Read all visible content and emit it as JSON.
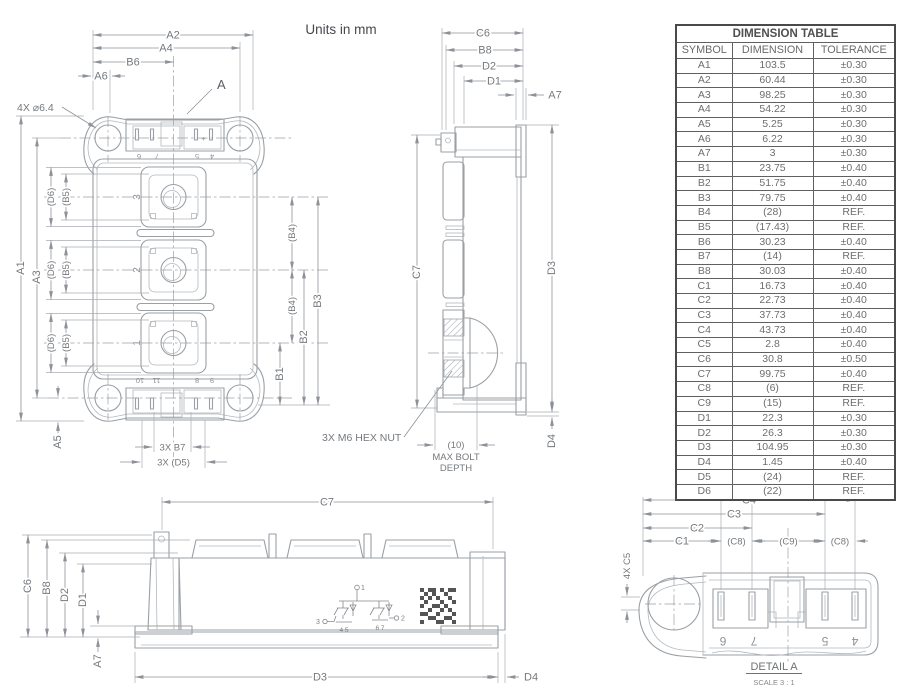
{
  "units_note": "Units in mm",
  "front_view": {
    "dims": {
      "a1": "A1",
      "a2": "A2",
      "a3": "A3",
      "a4": "A4",
      "a5": "A5",
      "a6": "A6",
      "b1": "B1",
      "b2": "B2",
      "b3": "B3",
      "b4": "(B4)",
      "b5": "(B5)",
      "b6": "B6",
      "d6": "(D6)",
      "b7": "3X B7",
      "d5": "3X (D5)"
    },
    "callouts": {
      "mounting_holes": "4X ⌀6.4",
      "detail": "A"
    },
    "terminal_numbers": [
      "3",
      "2",
      "1"
    ],
    "top_pin_numbers": [
      "6",
      "7",
      "5",
      "4"
    ],
    "bottom_pin_numbers": [
      "10",
      "11",
      "8",
      "9"
    ],
    "polarity_mark": "+"
  },
  "side_view": {
    "dims": {
      "c6": "C6",
      "b8": "B8",
      "d2": "D2",
      "d1": "D1",
      "a7": "A7",
      "c7": "C7",
      "d3": "D3",
      "d4": "D4"
    },
    "hex_nut_note": "3X M6 HEX NUT",
    "bolt_depth_note": [
      "(10)",
      "MAX BOLT",
      "DEPTH"
    ]
  },
  "bottom_view": {
    "dims": {
      "c7": "C7",
      "c6": "C6",
      "b8": "B8",
      "d2": "D2",
      "d1": "D1",
      "a7": "A7",
      "d3": "D3",
      "d4": "D4"
    },
    "schematic": {
      "node1": "1",
      "node2": "2",
      "node3": "3",
      "left_pins": "4 5",
      "right_pins": "6 7"
    }
  },
  "detail_view": {
    "dims": {
      "c1": "C1",
      "c2": "C2",
      "c3": "C3",
      "c4": "C4",
      "c8": "(C8)",
      "c9": "(C9)",
      "c5": "4X C5"
    },
    "pin_numbers": [
      "6",
      "7",
      "5",
      "4"
    ],
    "title": "DETAIL A",
    "scale_note": "SCALE 3 : 1"
  },
  "dimension_table": {
    "title": "DIMENSION TABLE",
    "columns": [
      "SYMBOL",
      "DIMENSION",
      "TOLERANCE"
    ],
    "rows": [
      [
        "A1",
        "103.5",
        "±0.30"
      ],
      [
        "A2",
        "60.44",
        "±0.30"
      ],
      [
        "A3",
        "98.25",
        "±0.30"
      ],
      [
        "A4",
        "54.22",
        "±0.30"
      ],
      [
        "A5",
        "5.25",
        "±0.30"
      ],
      [
        "A6",
        "6.22",
        "±0.30"
      ],
      [
        "A7",
        "3",
        "±0.30"
      ],
      [
        "B1",
        "23.75",
        "±0.40"
      ],
      [
        "B2",
        "51.75",
        "±0.40"
      ],
      [
        "B3",
        "79.75",
        "±0.40"
      ],
      [
        "B4",
        "(28)",
        "REF."
      ],
      [
        "B5",
        "(17.43)",
        "REF."
      ],
      [
        "B6",
        "30.23",
        "±0.40"
      ],
      [
        "B7",
        "(14)",
        "REF."
      ],
      [
        "B8",
        "30.03",
        "±0.40"
      ],
      [
        "C1",
        "16.73",
        "±0.40"
      ],
      [
        "C2",
        "22.73",
        "±0.40"
      ],
      [
        "C3",
        "37.73",
        "±0.40"
      ],
      [
        "C4",
        "43.73",
        "±0.40"
      ],
      [
        "C5",
        "2.8",
        "±0.40"
      ],
      [
        "C6",
        "30.8",
        "±0.50"
      ],
      [
        "C7",
        "99.75",
        "±0.40"
      ],
      [
        "C8",
        "(6)",
        "REF."
      ],
      [
        "C9",
        "(15)",
        "REF."
      ],
      [
        "D1",
        "22.3",
        "±0.30"
      ],
      [
        "D2",
        "26.3",
        "±0.30"
      ],
      [
        "D3",
        "104.95",
        "±0.30"
      ],
      [
        "D4",
        "1.45",
        "±0.40"
      ],
      [
        "D5",
        "(24)",
        "REF."
      ],
      [
        "D6",
        "(22)",
        "REF."
      ]
    ]
  }
}
